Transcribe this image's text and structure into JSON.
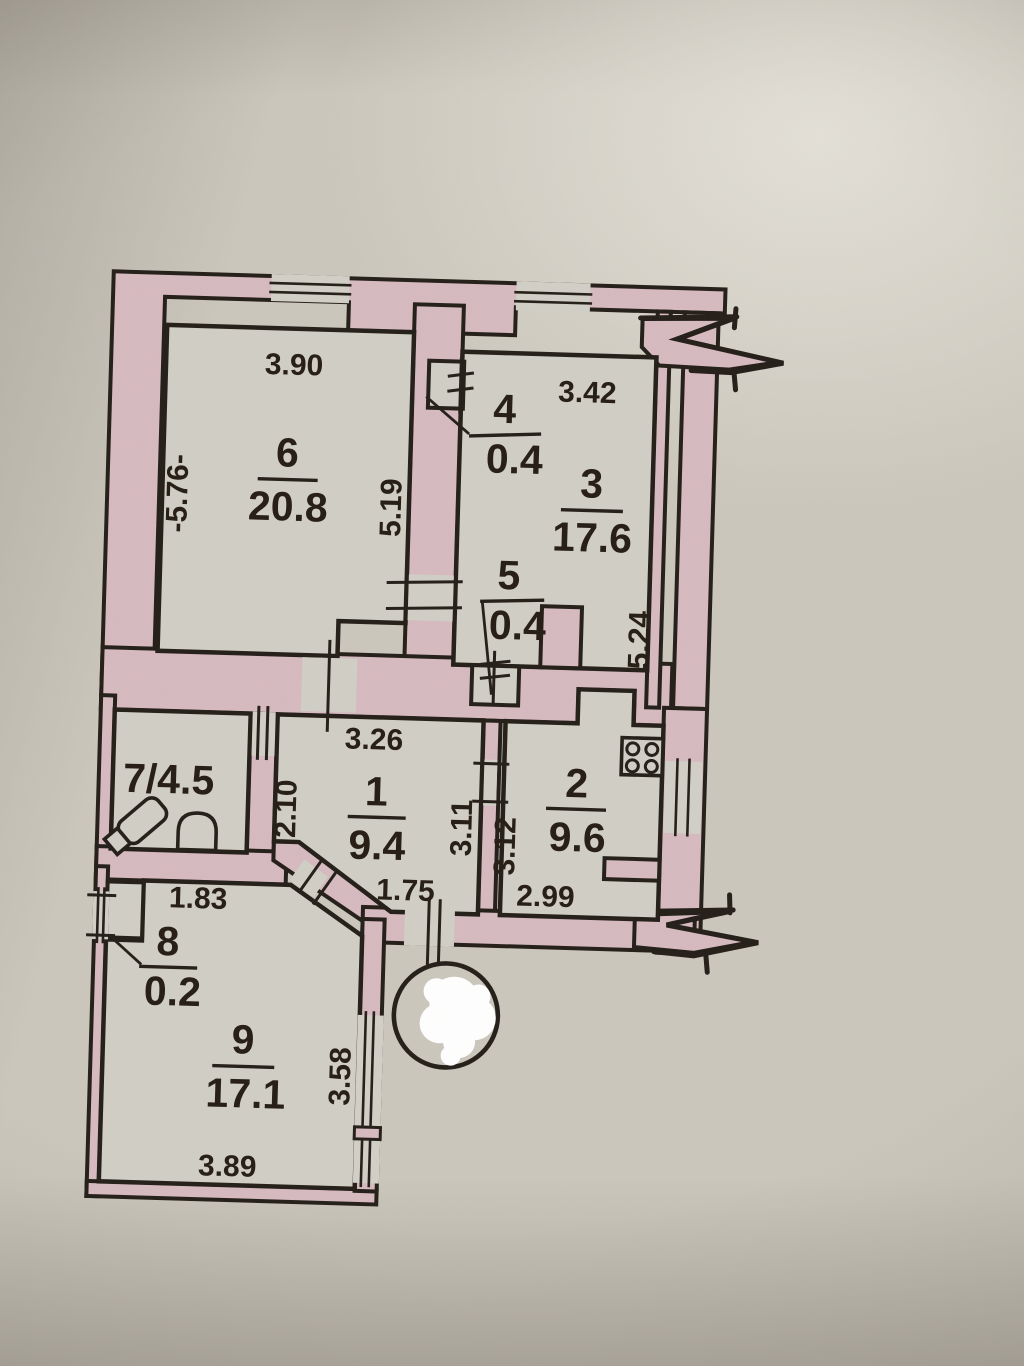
{
  "plan": {
    "title": "apartment floor plan",
    "rooms": {
      "r1": {
        "number": "1",
        "area": "9.4"
      },
      "r2": {
        "number": "2",
        "area": "9.6"
      },
      "r3": {
        "number": "3",
        "area": "17.6"
      },
      "r4": {
        "number": "4",
        "area": "0.4"
      },
      "r5": {
        "number": "5",
        "area": "0.4"
      },
      "r6": {
        "number": "6",
        "area": "20.8"
      },
      "r7": {
        "label": "7/4.5"
      },
      "r8": {
        "number": "8",
        "area": "0.2"
      },
      "r9": {
        "number": "9",
        "area": "17.1"
      }
    },
    "dims": {
      "top6": "3.90",
      "left6": "-5.76-",
      "right6": "5.19",
      "top3": "3.42",
      "right3": "5.24",
      "hall_top": "3.26",
      "bath_width": "2.10",
      "hall_right_a": "3.11",
      "hall_right_b": "3.12",
      "kitchen_bottom": "2.99",
      "entrance": "1.75",
      "room8_top": "1.83",
      "room9_right": "3.58",
      "room9_bottom": "3.89"
    },
    "colors": {
      "wall": "#d6bac0",
      "paper": "#d1cec5",
      "line": "#241e18"
    }
  }
}
